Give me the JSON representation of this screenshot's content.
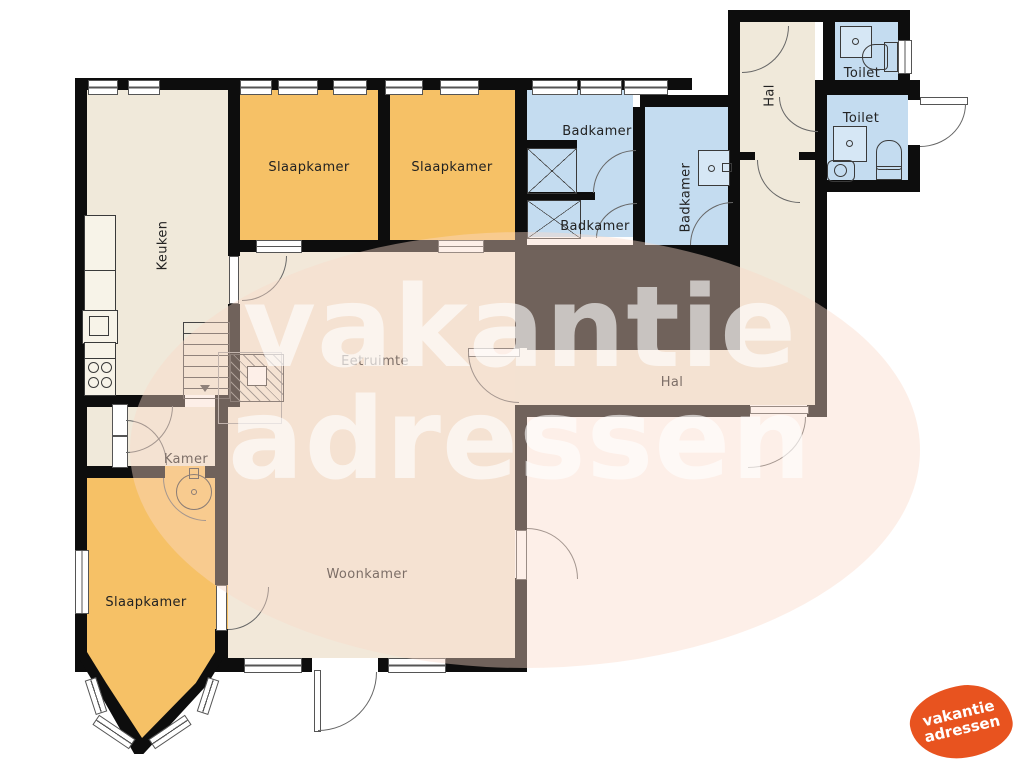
{
  "title": "Floor plan (vakantieadressen)",
  "rooms": {
    "keuken": "Keuken",
    "slaapkamer1": "Slaapkamer",
    "slaapkamer2": "Slaapkamer",
    "slaapkamer3": "Slaapkamer",
    "badkamer1": "Badkamer",
    "badkamer2": "Badkamer",
    "badkamer3": "Badkamer",
    "toilet1": "Toilet",
    "toilet2": "Toilet",
    "hal1": "Hal",
    "hal2": "Hal",
    "eetruimte": "Eetruimte",
    "kamer": "Kamer",
    "woonkamer": "Woonkamer"
  },
  "watermark": {
    "line1": "vakantie",
    "line2": "adressen"
  },
  "logo": {
    "line1": "vakantie",
    "line2": "adressen"
  },
  "colors": {
    "wall": "#0d0d0d",
    "room_beige": "#f0e9da",
    "room_orange": "#f6c166",
    "room_blue": "#c4dcf0",
    "watermark_pink": "#fad8c9",
    "logo_orange": "#e8531f"
  }
}
